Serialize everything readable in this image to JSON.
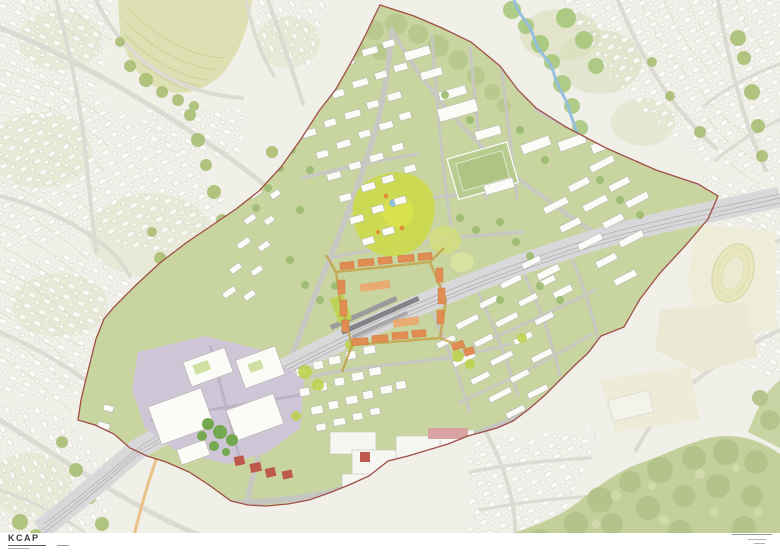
{
  "footer": {
    "logo": "KCAP"
  },
  "map": {
    "type": "urban-masterplan",
    "palette": {
      "background": "#f1f0e8",
      "district_green": "#c9d5a0",
      "boundary_red": "#9e4f46",
      "rail_gray": "#d8d8da",
      "development_orange": "#e08c52",
      "park_lime": "#cbd94f",
      "industry_lavender": "#cfc5da",
      "accent_red": "#bd5a4c",
      "forest_green": "#c4d09c",
      "field_yellow": "#dde0b2",
      "water_blue": "#93bedd",
      "track_oval": "#e7e6bd"
    }
  }
}
